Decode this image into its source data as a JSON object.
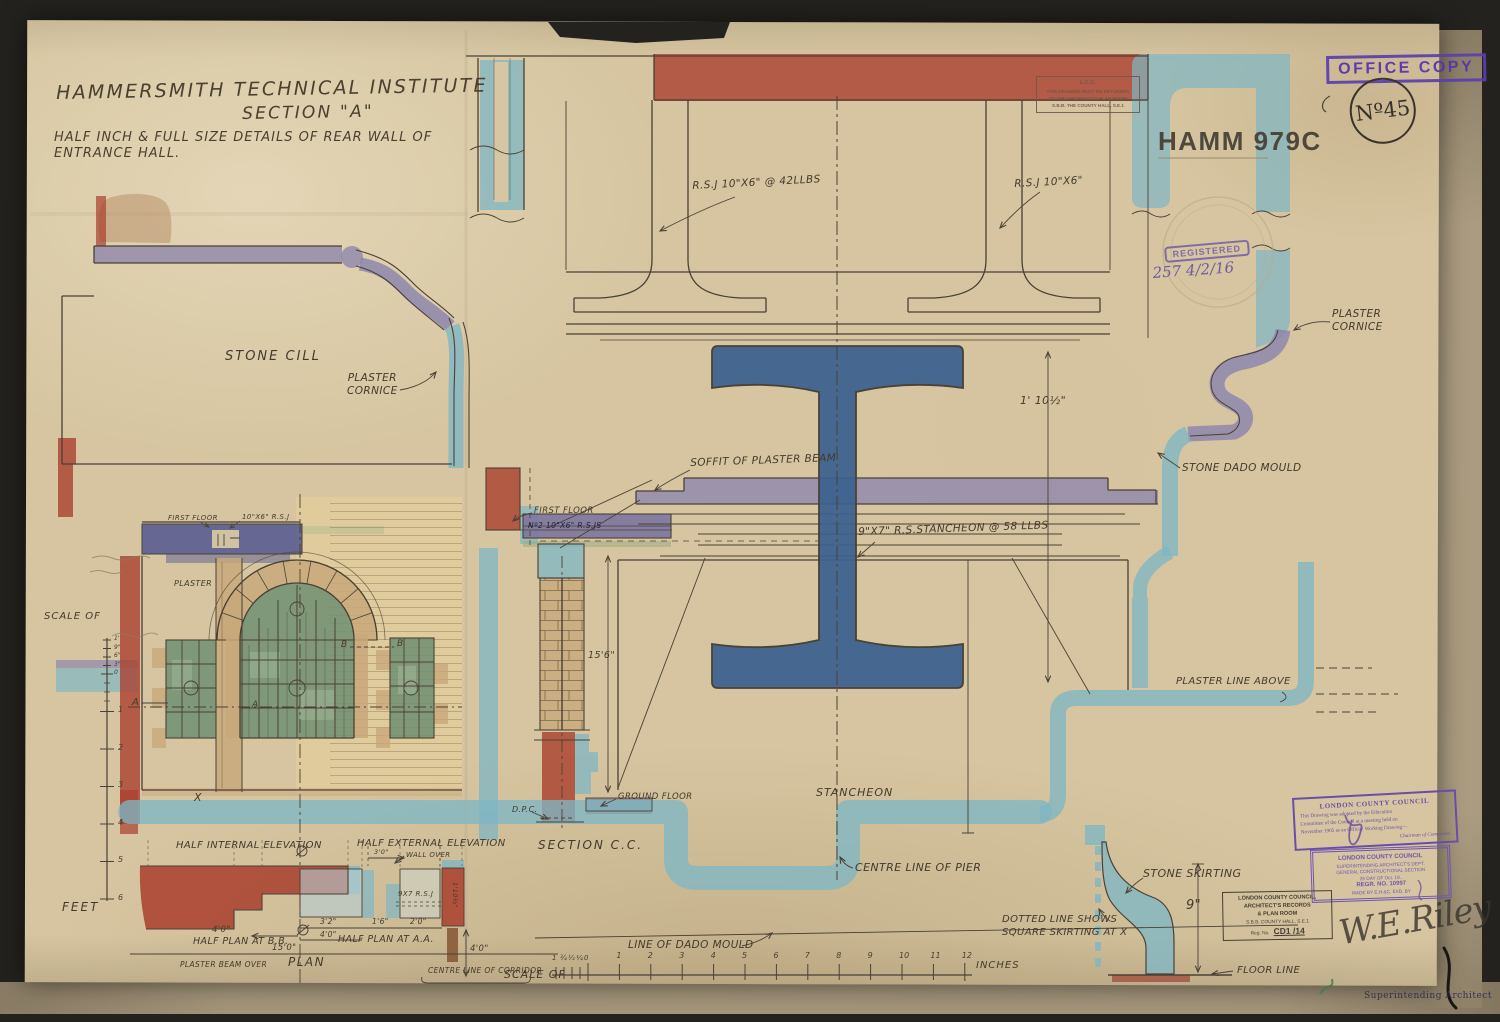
{
  "sheet": {
    "title_line1": "HAMMERSMITH TECHNICAL INSTITUTE",
    "title_line2": "SECTION \"A\"",
    "subtitle_line1": "HALF INCH & FULL SIZE DETAILS OF REAR WALL OF",
    "subtitle_line2": "ENTRANCE HALL."
  },
  "stamps": {
    "office_copy": "OFFICE COPY",
    "drawing_number": "Nº45",
    "hamm_code": "HAMM 979C",
    "registered": "REGISTERED",
    "registered_note": "257 4/2/16",
    "lcc_return": {
      "header": "L.C.C.",
      "body": "THIS DRAWING MUST BE RETURNED\nTO THE ARCHITECT'S PLAN ROOM\nS.B.B. THE COUNTY HALL, S.E.1"
    },
    "adopted": {
      "header": "LONDON COUNTY COUNCIL",
      "body": "This Drawing was adopted by the Education\nCommittee of the Council at a meeting held on\nNovember 1905 as an Official Working Drawing—",
      "footer": "Chairman of Committee."
    },
    "dept": {
      "header": "LONDON COUNTY COUNCIL",
      "line2": "SUPERINTENDING ARCHITECT'S DEPT.",
      "line3": "GENERAL CONSTRUCTIONAL SECTION",
      "line4": "26 DAY OF Oct. 19..",
      "line5": "REGR. NO. 10997",
      "line6": "MADE BY E.H.&C. EXD. BY"
    },
    "records": {
      "header": "LONDON COUNTY COUNCIL,\nARCHITECT'S RECORDS\n& PLAN ROOM",
      "line2": "S.B.B. COUNTY HALL, S.E.1",
      "reg_label": "Reg. No.",
      "reg_value": "CD1 /14"
    }
  },
  "signature": {
    "name": "W.E.Riley",
    "role": "Superintending Architect"
  },
  "labels": {
    "rsj_left": "R.S.J 10\"X6\" @ 42LLBS",
    "rsj_right": "R.S.J 10\"X6\"",
    "stone_cill": "STONE CILL",
    "plaster_cornice_left": "PLASTER\nCORNICE",
    "plaster_cornice_right": "PLASTER\nCORNICE",
    "soffit": "SOFFIT OF PLASTER BEAM",
    "stancheon_spec": "9\"X7\" R.S.STANCHEON @ 58 LLBS",
    "stone_dado": "STONE DADO MOULD",
    "plaster_line_above": "PLASTER LINE ABOVE",
    "stancheon": "STANCHEON",
    "centre_pier": "CENTRE LINE OF PIER",
    "stone_skirting": "STONE SKIRTING",
    "floor_line": "FLOOR LINE",
    "dotted_note": "DOTTED LINE SHOWS\nSQUARE SKIRTING AT X",
    "line_of_dado": "LINE OF DADO MOULD",
    "first_floor_elev": "FIRST FLOOR",
    "rsj_elev": "10\"X6\" R.S.J",
    "plaster_elev": "PLASTER",
    "first_floor_sec": "FIRST FLOOR",
    "rsjs_sec": "Nº2 10\"X6\" R.S.JS",
    "ground_floor": "GROUND FLOOR",
    "dpc": "D.P.C.",
    "section_cc": "SECTION C.C.",
    "half_internal": "HALF INTERNAL ELEVATION",
    "half_external": "HALF EXTERNAL ELEVATION",
    "wall_over": "WALL OVER",
    "half_plan_bb": "HALF PLAN AT B.B.",
    "half_plan_aa": "HALF PLAN AT A.A.",
    "plan": "PLAN",
    "plaster_beam_over": "PLASTER BEAM OVER",
    "centre_corridor": "CENTRE LINE OF CORRIDOR",
    "rsj_plan": "9X7 R.S.J",
    "marker_a": "A",
    "marker_a2": "A",
    "marker_b1": "B",
    "marker_b2": "B",
    "marker_x": "X"
  },
  "dimensions": {
    "stancheon_width": "1' 10½\"",
    "pier_height": "15'6\"",
    "skirting_height": "9\"",
    "wall_over_width": "3'0\"",
    "plan_4_0_a": "4'0\"",
    "plan_3_2": "3'2\"",
    "plan_4_0_b": "4'0\"",
    "plan_1_6": "1'6\"",
    "plan_2_0": "2'0\"",
    "plan_total": "15'0\"",
    "plan_4_0_c": "4'0\"",
    "plan_1_10": "1'10½\""
  },
  "scales": {
    "inches": {
      "prefix": "SCALE OF",
      "suffix": "INCHES",
      "sub_labels": [
        "1",
        "¾",
        "½",
        "¼",
        "0"
      ],
      "major_labels": [
        "1",
        "2",
        "3",
        "4",
        "5",
        "6",
        "7",
        "8",
        "9",
        "10",
        "11",
        "12"
      ]
    },
    "feet": {
      "prefix": "SCALE OF",
      "suffix": "FEET",
      "sub_labels": [
        "1'",
        "9\"",
        "6\"",
        "3\"",
        "0"
      ],
      "major_labels": [
        "1",
        "2",
        "3",
        "4",
        "5",
        "6"
      ]
    }
  },
  "colors": {
    "stone_wash": "#7fb6c4",
    "plaster_wash": "#8e86ad",
    "brick_wash": "#a93e2d",
    "steel_wash": "#3a5f8e",
    "buff_wash": "#e6cf9a",
    "stamp_purple": "#6a4caa",
    "ink": "#4a4136"
  }
}
